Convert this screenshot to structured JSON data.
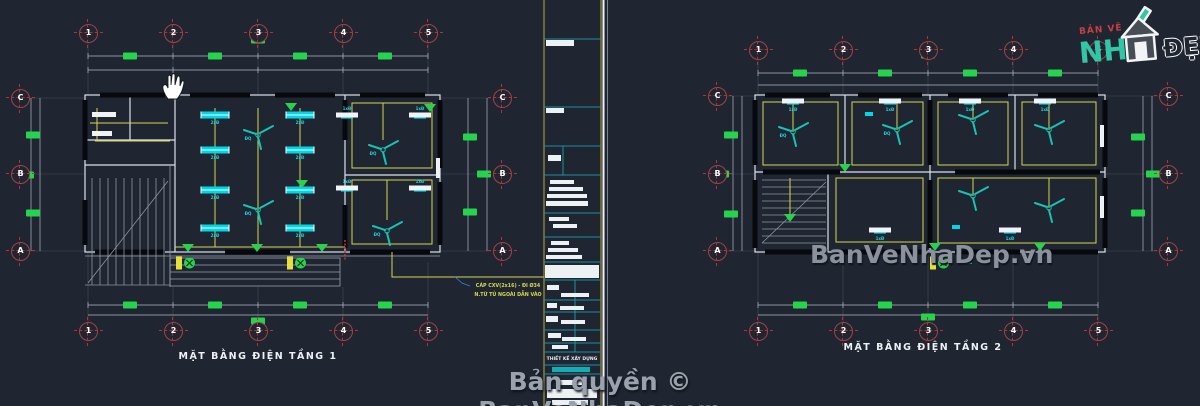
{
  "page": {
    "background": "#1f2531"
  },
  "logo": {
    "top_text": "BẢN VẼ",
    "main_text": "NH",
    "accent_text": "ĐẸP"
  },
  "watermark_text": "BanVeNhaDep.vn",
  "copyright_text": "Bản quyền © BanVeNhaDep.vn",
  "plans": {
    "left": {
      "title": "MẶT BẰNG ĐIỆN TẦNG 1",
      "grid_cols": [
        "1",
        "2",
        "3",
        "4",
        "5"
      ],
      "grid_rows": [
        "C",
        "B",
        "A"
      ]
    },
    "right": {
      "title": "MẶT BẰNG ĐIỆN TẦNG 2",
      "grid_cols": [
        "1",
        "2",
        "3",
        "4",
        "5"
      ],
      "grid_rows": [
        "C",
        "B",
        "A"
      ]
    }
  },
  "titleblock": {
    "firm_label": "THIẾT KẾ XÂY DỰNG"
  },
  "cable_note": {
    "line1": "CÁP CXV(2x16) - ĐI Ø34",
    "line2": "N.TỪ TỦ NGOÀI DẪN VÀO"
  },
  "fixture_labels": {
    "double_lamp": "2xĐ",
    "single_lamp": "1xĐ",
    "fan": "ĐQ"
  },
  "colors": {
    "accent_green": "#25d34c",
    "accent_cyan": "#00d6e8",
    "fan_teal": "#17c3b6",
    "wire_yellow": "#d6d64f",
    "grid_red": "#a04444",
    "logo_teal": "#2fc7a6"
  }
}
